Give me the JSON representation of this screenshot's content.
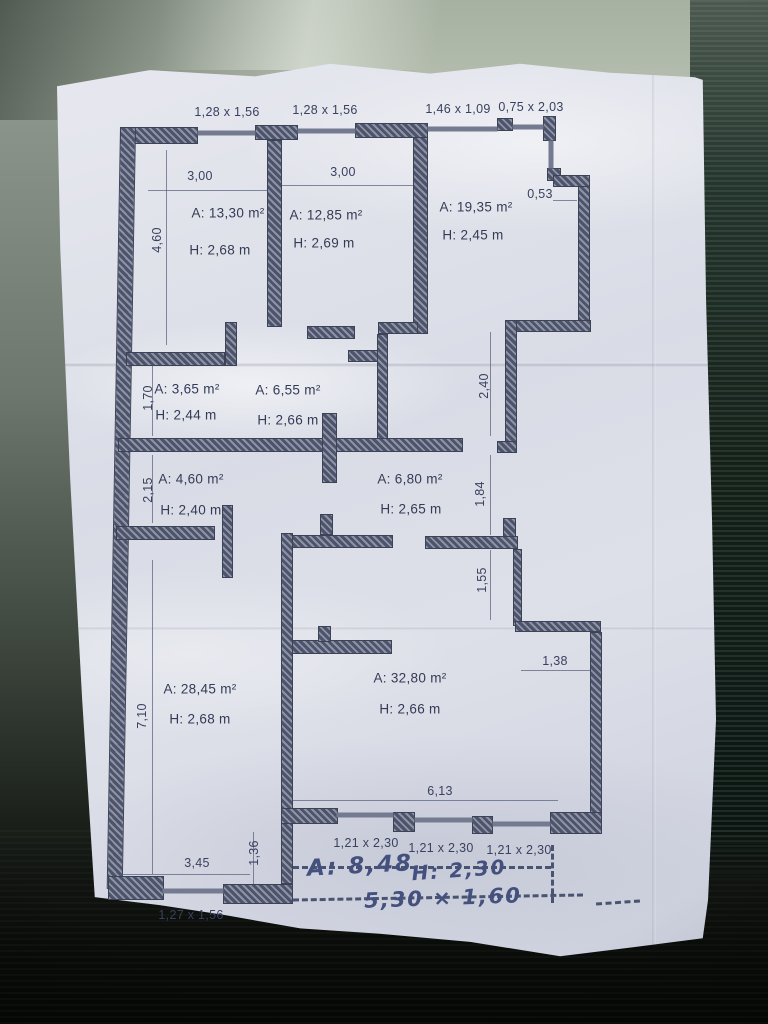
{
  "windows_top": [
    "1,28 x 1,56",
    "1,28 x 1,56",
    "1,46 x 1,09",
    "0,75 x 2,03"
  ],
  "windows_bottom": [
    "1,21 x 2,30",
    "1,21 x 2,30",
    "1,21 x 2,30"
  ],
  "window_bottom_left": "1,27 x 1,56",
  "rooms": [
    {
      "id": "room-1",
      "area": "A: 13,30 m²",
      "ceiling": "H: 2,68 m"
    },
    {
      "id": "room-2",
      "area": "A: 12,85 m²",
      "ceiling": "H: 2,69 m"
    },
    {
      "id": "room-3",
      "area": "A: 19,35 m²",
      "ceiling": "H: 2,45 m"
    },
    {
      "id": "room-4",
      "area": "A: 3,65 m²",
      "ceiling": "H: 2,44 m"
    },
    {
      "id": "room-5",
      "area": "A: 6,55 m²",
      "ceiling": "H: 2,66 m"
    },
    {
      "id": "room-6",
      "area": "A: 4,60 m²",
      "ceiling": "H: 2,40 m"
    },
    {
      "id": "room-7",
      "area": "A: 6,80 m²",
      "ceiling": "H: 2,65 m"
    },
    {
      "id": "room-8",
      "area": "A: 28,45 m²",
      "ceiling": "H: 2,68 m"
    },
    {
      "id": "room-9",
      "area": "A: 32,80 m²",
      "ceiling": "H: 2,66 m"
    }
  ],
  "dims": {
    "w300a": "3,00",
    "w300b": "3,00",
    "n053": "0,53",
    "v460": "4,60",
    "v170": "1,70",
    "v240": "2,40",
    "v215": "2,15",
    "v184": "1,84",
    "v155": "1,55",
    "v710": "7,10",
    "v136": "1,36",
    "h138": "1,38",
    "h613": "6,13",
    "h345": "3,45"
  },
  "handwriting": {
    "area": "A: 8,48",
    "height": "H: 2,30",
    "size": "5,30 × 1,60"
  },
  "colors": {
    "paper": "#d9dce6",
    "wall": "#4d536a",
    "print_text": "#333b56",
    "handwriting": "#44507e",
    "background_top": "#b6bfb0",
    "background_dark": "#0a0c09"
  }
}
